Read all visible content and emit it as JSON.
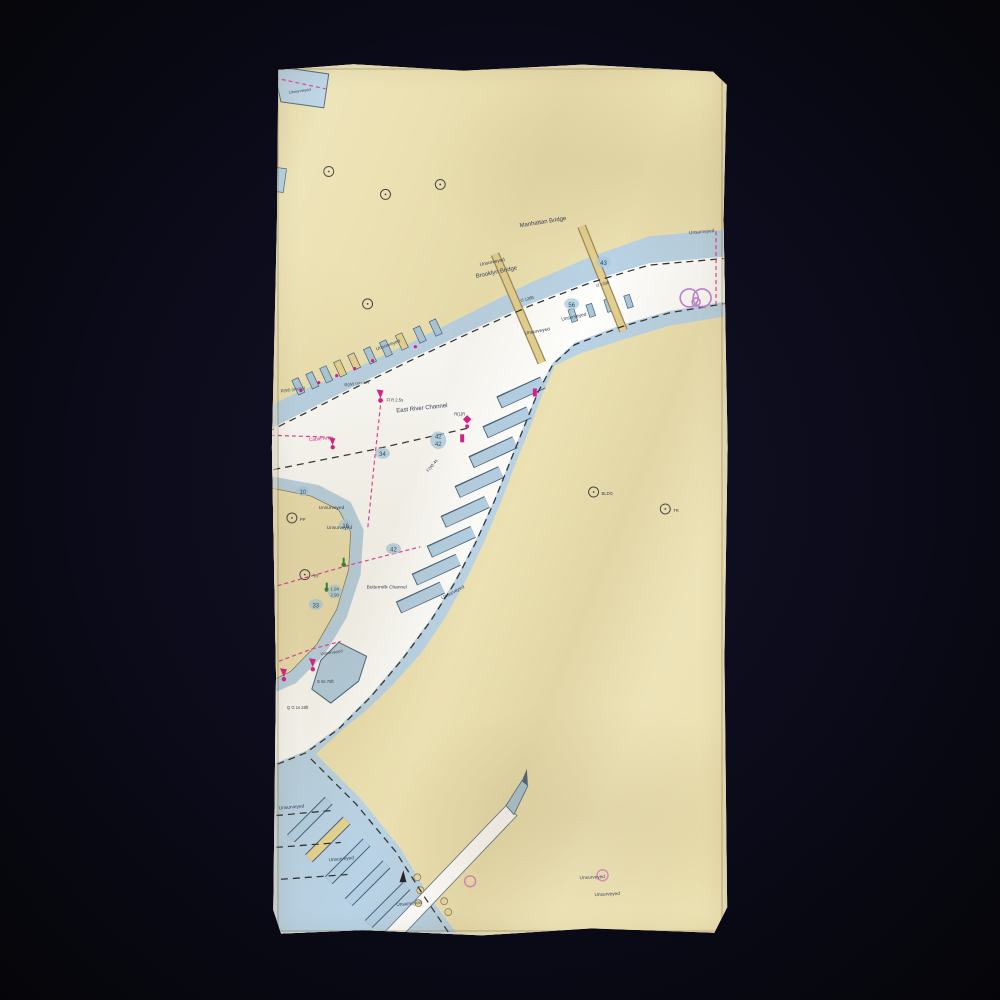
{
  "scene": {
    "description": "beach towel printed with a NOAA-style nautical chart of the East River and Upper New York Bay, lying on a dark background",
    "background_color": "#0b0b1a",
    "towel_fabric_color": "#efe6bd"
  },
  "chart": {
    "labels": {
      "manhattan_bridge": "Manhattan Bridge",
      "brooklyn_bridge": "Brooklyn Bridge",
      "clearance_133": "cl 133ft",
      "clearance_128": "cl 128ft",
      "east_river_channel": "East River Channel",
      "buttermilk_channel": "Buttermilk Channel",
      "unsurveyed": "Unsurveyed",
      "cable_area": "Cable Area",
      "building_abbrev": "BLDG",
      "tower_abbrev": "TR",
      "pile_abbrev": "PP",
      "light_fl_r_25s": "Fl R 2.5s",
      "light_r1r": "R(1)R",
      "light_fw4s": "F(W) 4s",
      "light_rw_occas": "R(W) (occas)",
      "light_qg_28ft": "Q G 1s 28ft",
      "light_g6s_76ft": "G 6s 76ft"
    },
    "depths": [
      "43",
      "56",
      "34",
      "42",
      "42",
      "42",
      "16",
      "33",
      "10",
      "1.94",
      "2.90"
    ],
    "colors": {
      "land_tan": "#ece1b2",
      "shallow_water_blue": "#b9d3e6",
      "deep_water_white": "#fdfdfb",
      "pier_fill": "#a9c6db",
      "outline_blue_gray": "#46607a",
      "magenta_aid": "#d81b8c",
      "green_aid": "#2e7d32",
      "bridge_tan": "#e3cf8e",
      "anchorage_purple": "#c07fd8",
      "dashed_channel_edge": "#333333"
    },
    "symbols": {
      "red_buoy": "magenta flare teardrop over dot",
      "green_buoy": "green dot with stem",
      "landmark_circle": "small circle with center dot",
      "anchorage_circles": "two overlapping purple circles",
      "cable_line": "magenta dashed line",
      "channel_edge": "black dashed line",
      "tank": "small tan circle",
      "beacon": "small black triangle"
    }
  }
}
